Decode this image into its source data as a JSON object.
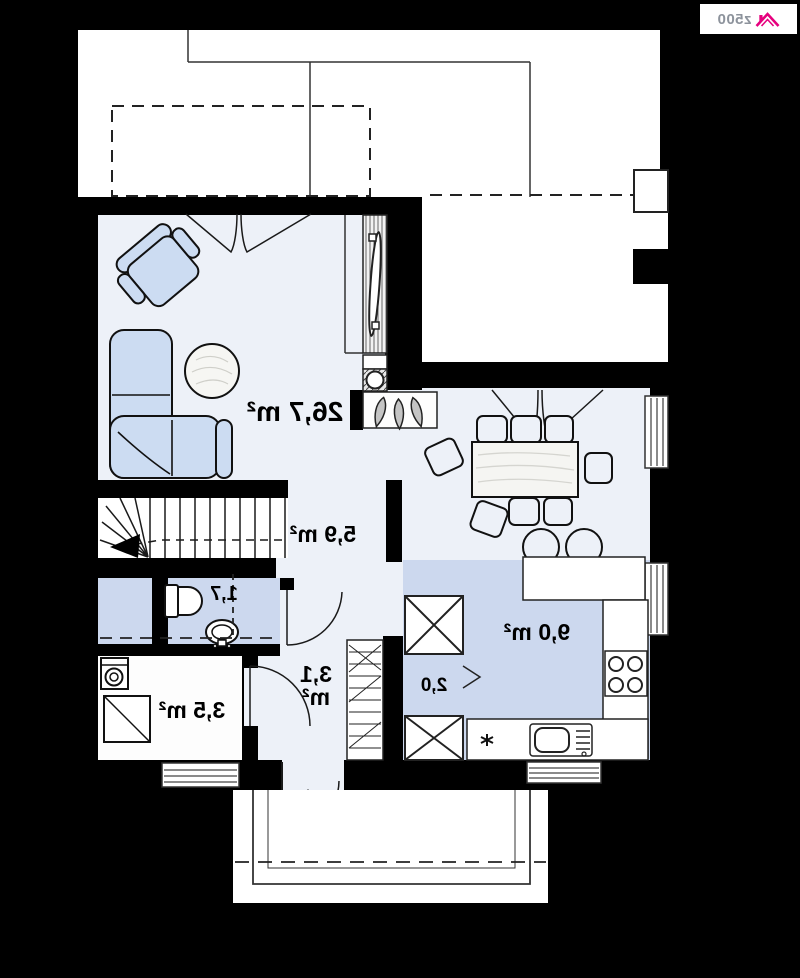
{
  "brand": {
    "logo_text": "z500",
    "accent_color": "#e6007e"
  },
  "floor_plan": {
    "orientation": "mirrored",
    "rooms": {
      "living_room": {
        "area": "26,7 m²"
      },
      "upper_hall": {
        "area": "5,9 m²"
      },
      "wc": {
        "area": "1,7"
      },
      "bathroom": {
        "area": "3,5 m²"
      },
      "entry_hall": {
        "area_value": "3,1",
        "area_unit": "m²"
      },
      "pantry": {
        "area": "2,0"
      },
      "kitchen": {
        "area": "9,0 m²"
      }
    }
  },
  "colors": {
    "background": "#000000",
    "plan_white": "#ffffff",
    "room_fill": "#edf1f8",
    "highlight_fill": "#ccd8ee",
    "furniture_fill": "#ccdcf2",
    "line": "#1a1a1a",
    "accent_pink": "#e6007e"
  }
}
